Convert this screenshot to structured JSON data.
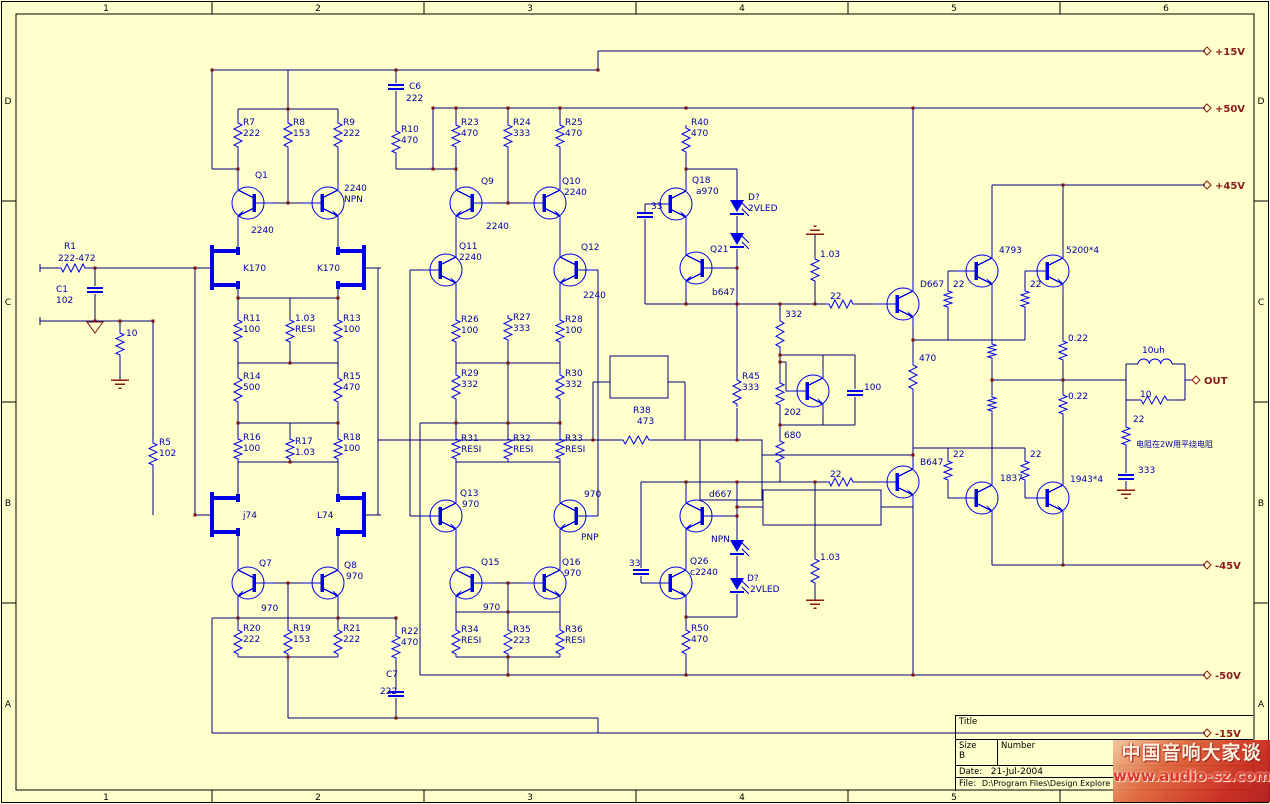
{
  "sheet": {
    "bg_color": "#FFFFCC",
    "wire_color": "#000080",
    "component_color": "#0000E8",
    "label_color": "#0000A8",
    "accent_color": "#8B1A1A",
    "top_zones": [
      "1",
      "2",
      "3",
      "4",
      "5",
      "6"
    ],
    "side_zones": [
      "D",
      "C",
      "B",
      "A"
    ]
  },
  "title_block": {
    "title_label": "Title",
    "size_label": "Size",
    "size_value": "B",
    "number_label": "Number",
    "revision_label": "Revision",
    "date_label": "Date:",
    "date_value": "21-Jul-2004",
    "sheet_label": "Sheet",
    "of_label": "of",
    "file_label": "File:",
    "file_value": "D:\\Program Files\\Design Explore 99 SE\\Examples\\MyDesign.ddb",
    "drawn_label": "Drawn By:"
  },
  "watermark": {
    "line1": "中国音响大家谈",
    "line2": "www.audio-sz.com"
  },
  "schematic": {
    "note": "电阻在2W用平绕电阻",
    "power_ports": [
      {
        "t": "+15V",
        "x": 1203,
        "y": 51
      },
      {
        "t": "+50V",
        "x": 1203,
        "y": 108
      },
      {
        "t": "+45V",
        "x": 1203,
        "y": 185
      },
      {
        "t": "-45V",
        "x": 1203,
        "y": 565
      },
      {
        "t": "-50V",
        "x": 1203,
        "y": 675
      },
      {
        "t": "-15V",
        "x": 1203,
        "y": 733
      },
      {
        "t": "OUT",
        "x": 1192,
        "y": 380
      }
    ],
    "labels": [
      [
        64,
        249,
        "R1"
      ],
      [
        58,
        261,
        "222-472"
      ],
      [
        56,
        292,
        "C1"
      ],
      [
        56,
        303,
        "102"
      ],
      [
        126,
        336,
        "10"
      ],
      [
        159,
        445,
        "R5"
      ],
      [
        159,
        456,
        "102"
      ],
      [
        243,
        271,
        "K170"
      ],
      [
        317,
        271,
        "K170"
      ],
      [
        243,
        518,
        "j74"
      ],
      [
        317,
        518,
        "L74"
      ],
      [
        255,
        178,
        "Q1"
      ],
      [
        251,
        233,
        "2240"
      ],
      [
        344,
        191,
        "2240"
      ],
      [
        344,
        202,
        "NPN"
      ],
      [
        259,
        566,
        "Q7"
      ],
      [
        261,
        611,
        "970"
      ],
      [
        344,
        568,
        "Q8"
      ],
      [
        346,
        579,
        "970"
      ],
      [
        243,
        125,
        "R7"
      ],
      [
        243,
        136,
        "222"
      ],
      [
        293,
        125,
        "R8"
      ],
      [
        293,
        136,
        "153"
      ],
      [
        343,
        125,
        "R9"
      ],
      [
        343,
        136,
        "222"
      ],
      [
        401,
        132,
        "R10"
      ],
      [
        401,
        143,
        "470"
      ],
      [
        409,
        89,
        "C6"
      ],
      [
        406,
        101,
        "222"
      ],
      [
        243,
        321,
        "R11"
      ],
      [
        243,
        332,
        "100"
      ],
      [
        295,
        321,
        "1.03"
      ],
      [
        295,
        332,
        "RESI"
      ],
      [
        343,
        321,
        "R13"
      ],
      [
        343,
        332,
        "100"
      ],
      [
        243,
        379,
        "R14"
      ],
      [
        243,
        390,
        "500"
      ],
      [
        343,
        379,
        "R15"
      ],
      [
        343,
        390,
        "470"
      ],
      [
        243,
        440,
        "R16"
      ],
      [
        243,
        451,
        "100"
      ],
      [
        295,
        444,
        "R17"
      ],
      [
        295,
        455,
        "1.03"
      ],
      [
        343,
        440,
        "R18"
      ],
      [
        343,
        451,
        "100"
      ],
      [
        243,
        631,
        "R20"
      ],
      [
        243,
        642,
        "222"
      ],
      [
        293,
        631,
        "R19"
      ],
      [
        293,
        642,
        "153"
      ],
      [
        343,
        631,
        "R21"
      ],
      [
        343,
        642,
        "222"
      ],
      [
        401,
        634,
        "R22"
      ],
      [
        401,
        645,
        "470"
      ],
      [
        386,
        677,
        "C7"
      ],
      [
        380,
        694,
        "222"
      ],
      [
        461,
        125,
        "R23"
      ],
      [
        461,
        136,
        "470"
      ],
      [
        513,
        125,
        "R24"
      ],
      [
        513,
        136,
        "333"
      ],
      [
        565,
        125,
        "R25"
      ],
      [
        565,
        136,
        "470"
      ],
      [
        481,
        184,
        "Q9"
      ],
      [
        486,
        229,
        "2240"
      ],
      [
        562,
        184,
        "Q10"
      ],
      [
        564,
        195,
        "2240"
      ],
      [
        459,
        249,
        "Q11"
      ],
      [
        459,
        260,
        "2240"
      ],
      [
        581,
        250,
        "Q12"
      ],
      [
        583,
        298,
        "2240"
      ],
      [
        461,
        322,
        "R26"
      ],
      [
        461,
        333,
        "100"
      ],
      [
        513,
        320,
        "R27"
      ],
      [
        513,
        331,
        "333"
      ],
      [
        565,
        322,
        "R28"
      ],
      [
        565,
        333,
        "100"
      ],
      [
        461,
        376,
        "R29"
      ],
      [
        461,
        387,
        "332"
      ],
      [
        565,
        376,
        "R30"
      ],
      [
        565,
        387,
        "332"
      ],
      [
        461,
        441,
        "R31"
      ],
      [
        461,
        452,
        "RESI"
      ],
      [
        513,
        441,
        "R32"
      ],
      [
        513,
        452,
        "RESI"
      ],
      [
        565,
        441,
        "R33"
      ],
      [
        565,
        452,
        "RESI"
      ],
      [
        633,
        413,
        "R38"
      ],
      [
        637,
        424,
        "473"
      ],
      [
        460,
        496,
        "Q13"
      ],
      [
        462,
        507,
        "970"
      ],
      [
        584,
        497,
        "970"
      ],
      [
        581,
        540,
        "PNP"
      ],
      [
        481,
        565,
        "Q15"
      ],
      [
        483,
        610,
        "970"
      ],
      [
        562,
        565,
        "Q16"
      ],
      [
        564,
        576,
        "970"
      ],
      [
        461,
        632,
        "R34"
      ],
      [
        461,
        643,
        "RESI"
      ],
      [
        513,
        632,
        "R35"
      ],
      [
        513,
        643,
        "223"
      ],
      [
        565,
        632,
        "R36"
      ],
      [
        565,
        643,
        "RESI"
      ],
      [
        691,
        125,
        "R40"
      ],
      [
        691,
        136,
        "470"
      ],
      [
        651,
        209,
        "33"
      ],
      [
        629,
        566,
        "33"
      ],
      [
        692,
        183,
        "Q18"
      ],
      [
        696,
        194,
        "a970"
      ],
      [
        710,
        252,
        "Q21"
      ],
      [
        712,
        295,
        "b647"
      ],
      [
        748,
        200,
        "D?"
      ],
      [
        748,
        211,
        "2VLED"
      ],
      [
        709,
        497,
        "d667"
      ],
      [
        711,
        542,
        "NPN"
      ],
      [
        690,
        564,
        "Q26"
      ],
      [
        690,
        575,
        "c2240"
      ],
      [
        747,
        581,
        "D?"
      ],
      [
        750,
        592,
        "2VLED"
      ],
      [
        742,
        379,
        "R45"
      ],
      [
        742,
        390,
        "333"
      ],
      [
        785,
        317,
        "332"
      ],
      [
        784,
        415,
        "202"
      ],
      [
        784,
        438,
        "680"
      ],
      [
        820,
        257,
        "1.03"
      ],
      [
        820,
        560,
        "1.03"
      ],
      [
        864,
        390,
        "100"
      ],
      [
        830,
        299,
        "22"
      ],
      [
        830,
        477,
        "22"
      ],
      [
        919,
        361,
        "470"
      ],
      [
        691,
        631,
        "R50"
      ],
      [
        691,
        642,
        "470"
      ],
      [
        920,
        287,
        "D667"
      ],
      [
        920,
        465,
        "B647"
      ],
      [
        953,
        287,
        "22"
      ],
      [
        1030,
        287,
        "22"
      ],
      [
        953,
        457,
        "22"
      ],
      [
        1030,
        457,
        "22"
      ],
      [
        999,
        253,
        "4793"
      ],
      [
        1066,
        253,
        "5200*4"
      ],
      [
        1000,
        481,
        "1837"
      ],
      [
        1070,
        482,
        "1943*4"
      ],
      [
        1068,
        341,
        "0.22"
      ],
      [
        1068,
        399,
        "0.22"
      ],
      [
        1142,
        353,
        "10uh"
      ],
      [
        1140,
        397,
        "10"
      ],
      [
        1133,
        422,
        "22"
      ],
      [
        1138,
        473,
        "333"
      ]
    ]
  }
}
